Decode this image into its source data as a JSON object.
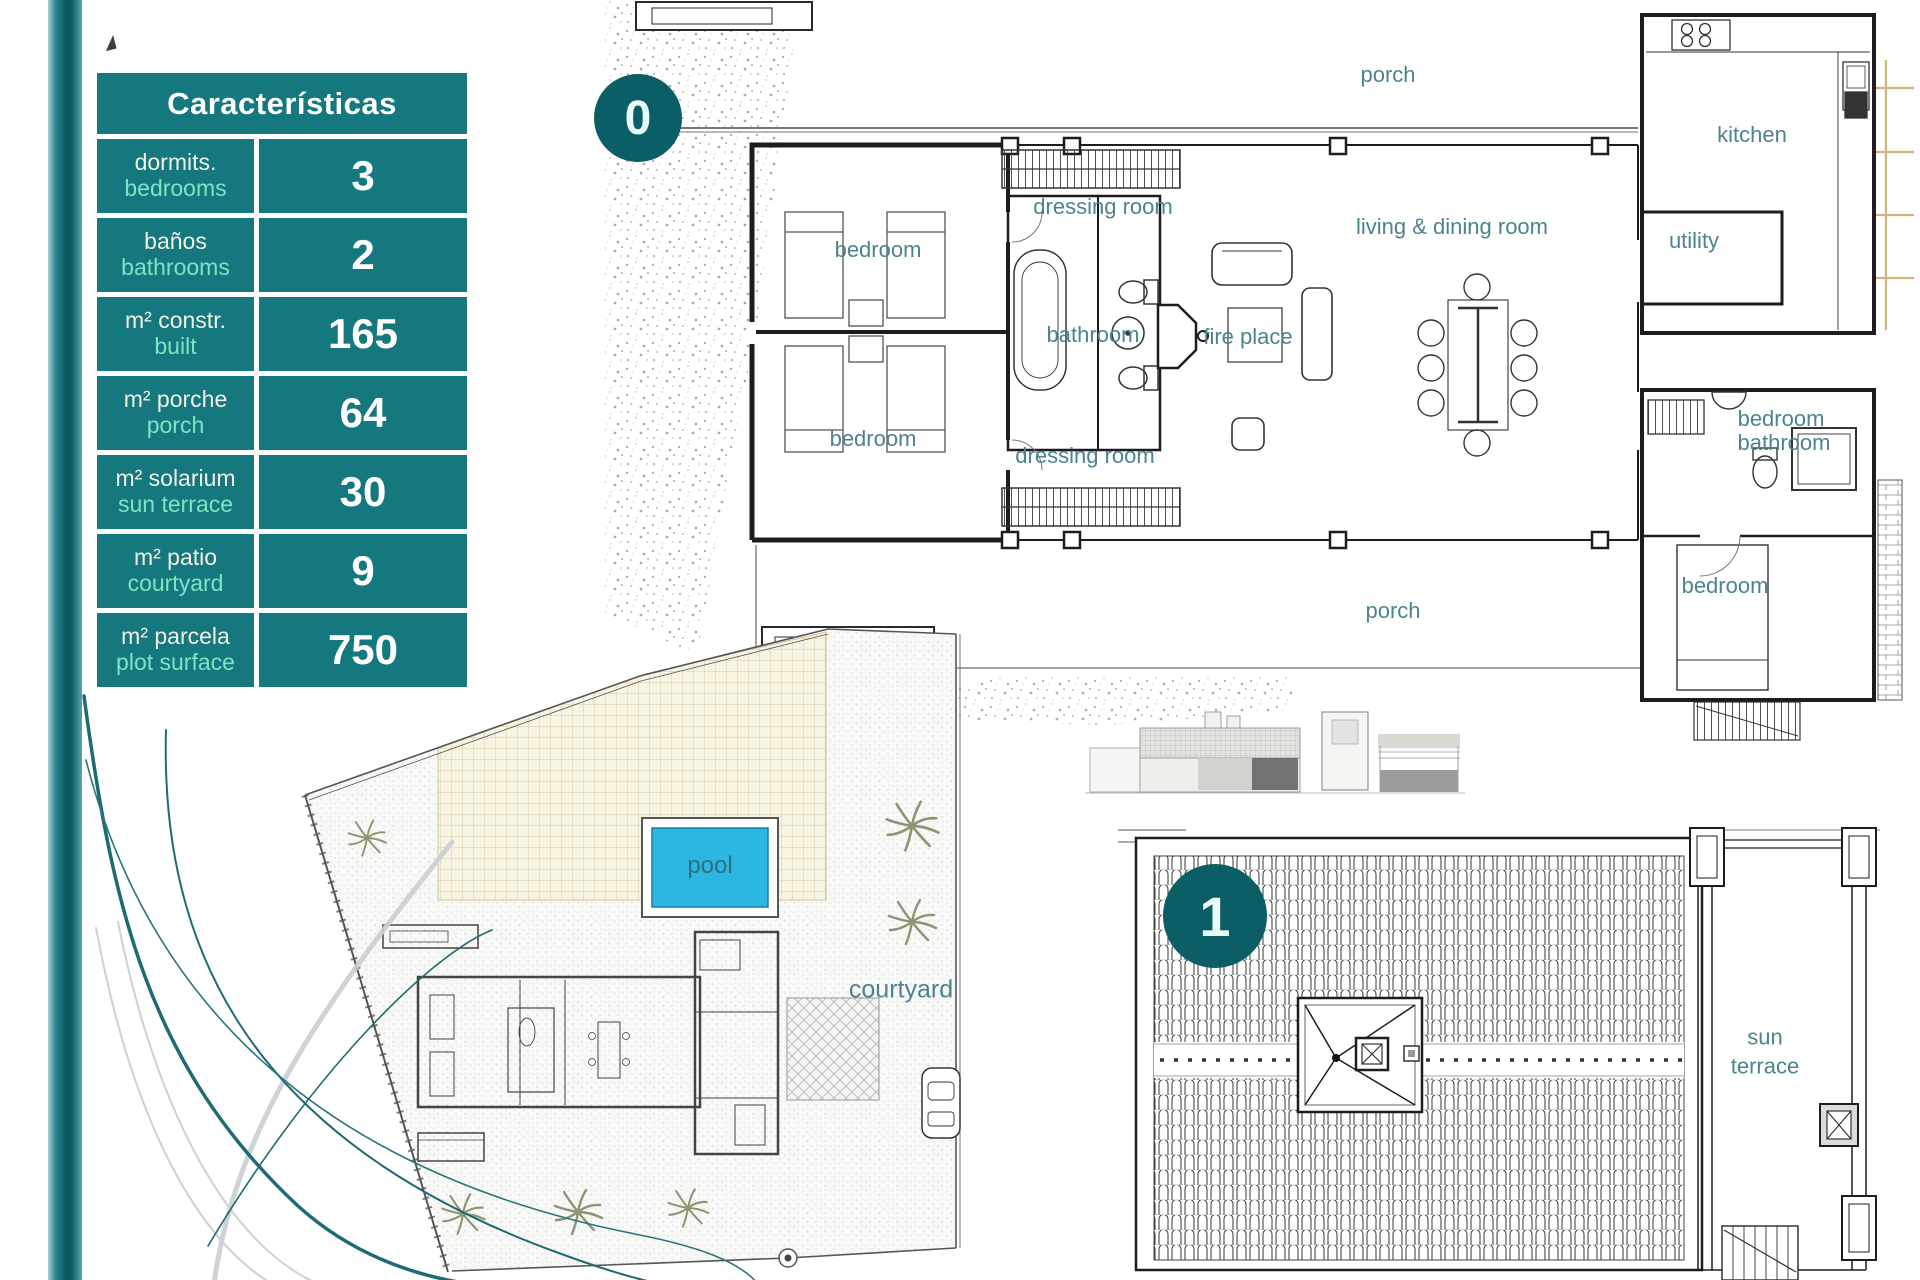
{
  "colors": {
    "teal": "#15787e",
    "teal_dark": "#0c5e66",
    "mint": "#79e7c2",
    "room_label": "#4d838e",
    "pool_blue": "#2cb6e3"
  },
  "table": {
    "title": "Características",
    "rows": [
      {
        "es": "dormits.",
        "en": "bedrooms",
        "value": "3"
      },
      {
        "es": "baños",
        "en": "bathrooms",
        "value": "2"
      },
      {
        "es": "m² constr.",
        "en": "built",
        "value": "165"
      },
      {
        "es": "m² porche",
        "en": "porch",
        "value": "64"
      },
      {
        "es": "m² solarium",
        "en": "sun terrace",
        "value": "30"
      },
      {
        "es": "m² patio",
        "en": "courtyard",
        "value": "9"
      },
      {
        "es": "m² parcela",
        "en": "plot surface",
        "value": "750"
      }
    ]
  },
  "badges": {
    "floor0": "0",
    "floor1": "1"
  },
  "floor0": {
    "labels": {
      "porch_top": "porch",
      "kitchen": "kitchen",
      "dressing_top": "dressing room",
      "living": "living & dining room",
      "utility": "utility",
      "bedroom_top": "bedroom",
      "bathroom_left": "bathroom",
      "fireplace": "fire place",
      "bedroom_right": "bedroom",
      "bathroom_right": "bathroom",
      "bedroom_bottom_left": "bedroom",
      "dressing_bottom": "dressing room",
      "bedroom_bottom_right": "bedroom",
      "porch_bottom": "porch"
    }
  },
  "site": {
    "labels": {
      "pool": "pool",
      "courtyard": "courtyard"
    }
  },
  "floor1": {
    "labels": {
      "sun_terrace": "sun terrace"
    }
  }
}
